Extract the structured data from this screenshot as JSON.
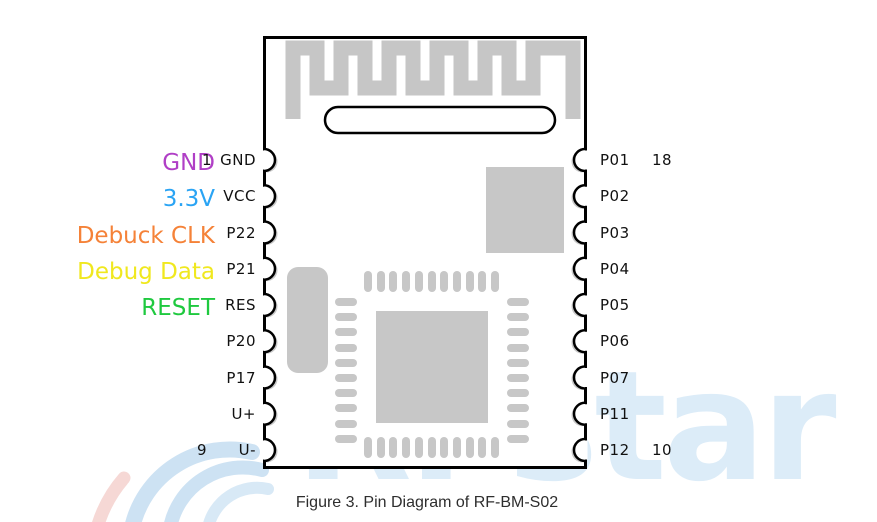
{
  "caption": "Figure 3. Pin Diagram of RF-BM-S02",
  "watermark": {
    "text": "RFstar"
  },
  "module": {
    "name": "RF-BM-S02",
    "left_pins": [
      {
        "name": "GND",
        "number": "1"
      },
      {
        "name": "VCC"
      },
      {
        "name": "P22"
      },
      {
        "name": "P21"
      },
      {
        "name": "RES"
      },
      {
        "name": "P20"
      },
      {
        "name": "P17"
      },
      {
        "name": "U+"
      },
      {
        "name": "U-",
        "number": "9"
      }
    ],
    "right_pins": [
      {
        "name": "P01",
        "number": "18"
      },
      {
        "name": "P02"
      },
      {
        "name": "P03"
      },
      {
        "name": "P04"
      },
      {
        "name": "P05"
      },
      {
        "name": "P06"
      },
      {
        "name": "P07"
      },
      {
        "name": "P11"
      },
      {
        "name": "P12",
        "number": "10"
      }
    ],
    "annotations": [
      {
        "label": "GND",
        "color": "#b03fc6",
        "target_pin": "GND"
      },
      {
        "label": "3.3V",
        "color": "#2aa4f4",
        "target_pin": "VCC"
      },
      {
        "label": "Debuck CLK",
        "color": "#f58238",
        "target_pin": "P22"
      },
      {
        "label": "Debug Data",
        "color": "#f0e81f",
        "target_pin": "P21"
      },
      {
        "label": "RESET",
        "color": "#1fc93f",
        "target_pin": "RES"
      }
    ]
  },
  "colors": {
    "board_outline": "#000000",
    "copper_pad": "#c7c7c7",
    "watermark_blue": "#dcecf8",
    "watermark_pink": "#f6d8d5"
  }
}
